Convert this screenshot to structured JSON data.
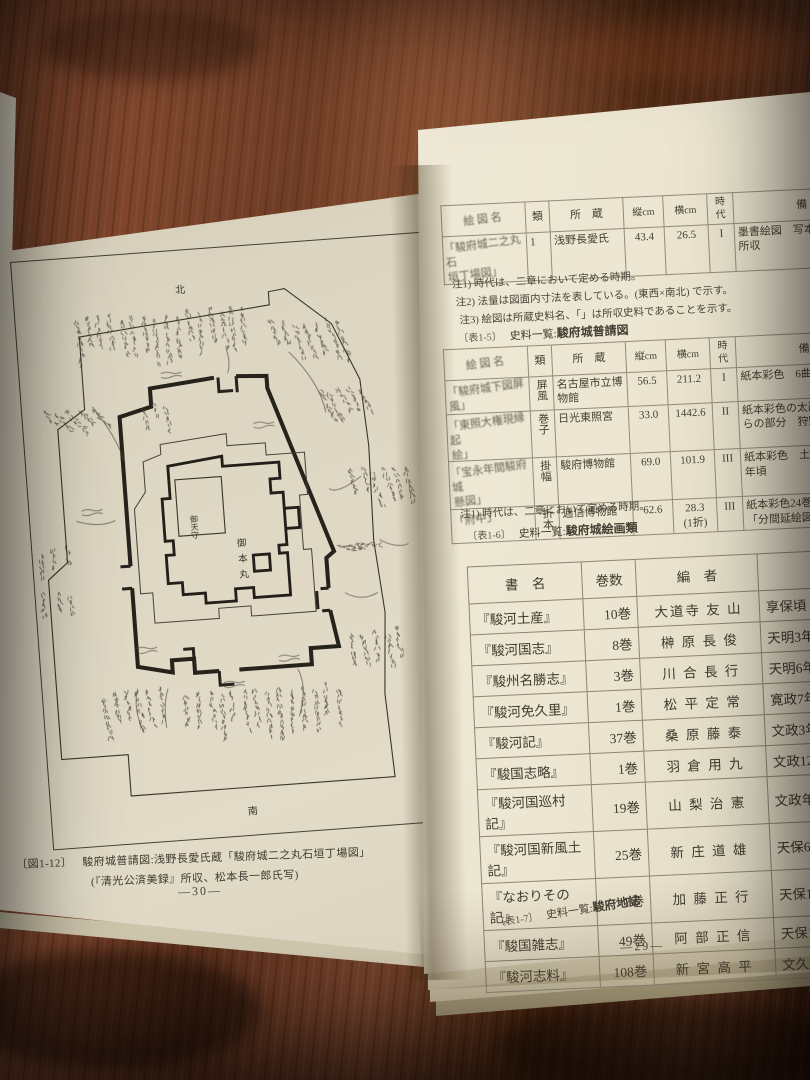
{
  "photo": {
    "wood_base": "#5b3320",
    "wood_dark": "#2e160c",
    "wood_light": "#8a5134",
    "paper_left": "#ded7c3",
    "paper_right": "#ece7d4",
    "ink": "#39342c",
    "rule_line": "#948c79"
  },
  "left_page": {
    "map": {
      "north": "北",
      "east": "東",
      "south": "南",
      "tenshu": "御天守",
      "honmaru": "御本丸",
      "handwritten_labels": "illegible small handwriting around walls"
    },
    "caption_label": "〔図1-12〕",
    "caption_line1": "駿府城普請図:浅野長愛氏蔵「駿府城二之丸石垣丁場図」",
    "caption_line2": "(『清光公済美録』所収、松本長一郎氏写)",
    "page_number": "―30―"
  },
  "right_page": {
    "table_fushin": {
      "headers": [
        "絵 図 名",
        "類",
        "所　蔵",
        "縦cm",
        "横cm",
        "時代",
        "備　　考"
      ],
      "col_widths": [
        84,
        24,
        74,
        40,
        44,
        26,
        170
      ],
      "rows": [
        [
          "「駿府城二之丸石\n垣丁場図」",
          "1",
          "浅野長愛氏",
          "43.4",
          "26.5",
          "I",
          "墨書絵図　写本 「清光公済美録」\n所収"
        ]
      ],
      "notes": [
        "注1) 時代は、二章において定める時期。",
        "注2) 法量は図面内寸法を表している。(東西×南北) で示す。",
        "注3) 絵図は所蔵史料名、「」は所収史料であることを示す。"
      ],
      "caption_prefix": "〔表1-5〕",
      "caption_title": "史料一覧:",
      "caption_subject": "駿府城普請図"
    },
    "table_kaiga": {
      "headers": [
        "絵 図 名",
        "類",
        "所　蔵",
        "縦cm",
        "横cm",
        "時代",
        "備　　考"
      ],
      "col_widths": [
        84,
        24,
        74,
        40,
        44,
        26,
        170
      ],
      "rows": [
        [
          "「駿府城下図屏\n風」",
          "屏風",
          "名古屋市立博\n物館",
          "56.5",
          "211.2",
          "I",
          "紙本彩色　6曲半双小屏風"
        ],
        [
          "「東照大権現縁起\n絵」",
          "巻子",
          "日光東照宮",
          "33.0",
          "1442.6",
          "II",
          "紙本彩色の太政大臣宣下か\nらの部分　狩野探幽筆第2巻"
        ],
        [
          "「宝永年間駿府城\n懸図」",
          "掛幅",
          "駿府博物館",
          "69.0",
          "101.9",
          "III",
          "紙本彩色　土佐光成筆　宝永\n年頃"
        ],
        [
          "「府中」",
          "折本",
          "逓信博物館",
          "62.6",
          "28.3\n(1折)",
          "III",
          "紙本彩色24巻の中第9巻\n「分間延絵図」部分"
        ]
      ],
      "notes": [
        "注1) 時代は、二章において定める時期。"
      ],
      "caption_prefix": "〔表1-6〕",
      "caption_title": "史料一覧:",
      "caption_subject": "駿府城絵画類"
    },
    "table_chishi": {
      "headers": [
        "書　名",
        "巻数",
        "編　者",
        "編　年"
      ],
      "col_widths": [
        114,
        54,
        122,
        170
      ],
      "rows": [
        [
          "『駿河土産』",
          "10巻",
          "大道寺 友 山",
          "享保頃"
        ],
        [
          "『駿河国志』",
          "8巻",
          "榊 原 長 俊",
          "天明3年(1"
        ],
        [
          "『駿州名勝志』",
          "3巻",
          "川 合 長 行",
          "天明6年(1"
        ],
        [
          "『駿河免久里』",
          "1巻",
          "松 平 定 常",
          "寛政7年(1"
        ],
        [
          "『駿河記』",
          "37巻",
          "桑 原 藤 泰",
          "文政3年(1"
        ],
        [
          "『駿国志略』",
          "1巻",
          "羽 倉 用 九",
          "文政12年(1"
        ],
        [
          "『駿河国巡村記』",
          "19巻",
          "山 梨 治 憲",
          "文政年度頃"
        ],
        [
          "『駿河国新風土記』",
          "25巻",
          "新 庄 道 雄",
          "天保6年(1"
        ],
        [
          "『なおりその記』",
          "7巻",
          "加 藤 正 行",
          "天保13年(1"
        ],
        [
          "『駿国雑志』",
          "49巻",
          "阿 部 正 信",
          "天保13年(1"
        ],
        [
          "『駿河志料』",
          "108巻",
          "新 宮 高 平",
          "文久元年(1"
        ]
      ],
      "caption_prefix": "〔表1-7〕",
      "caption_title": "史料一覧:",
      "caption_subject": "駿府地誌"
    },
    "page_number": "―29―"
  }
}
